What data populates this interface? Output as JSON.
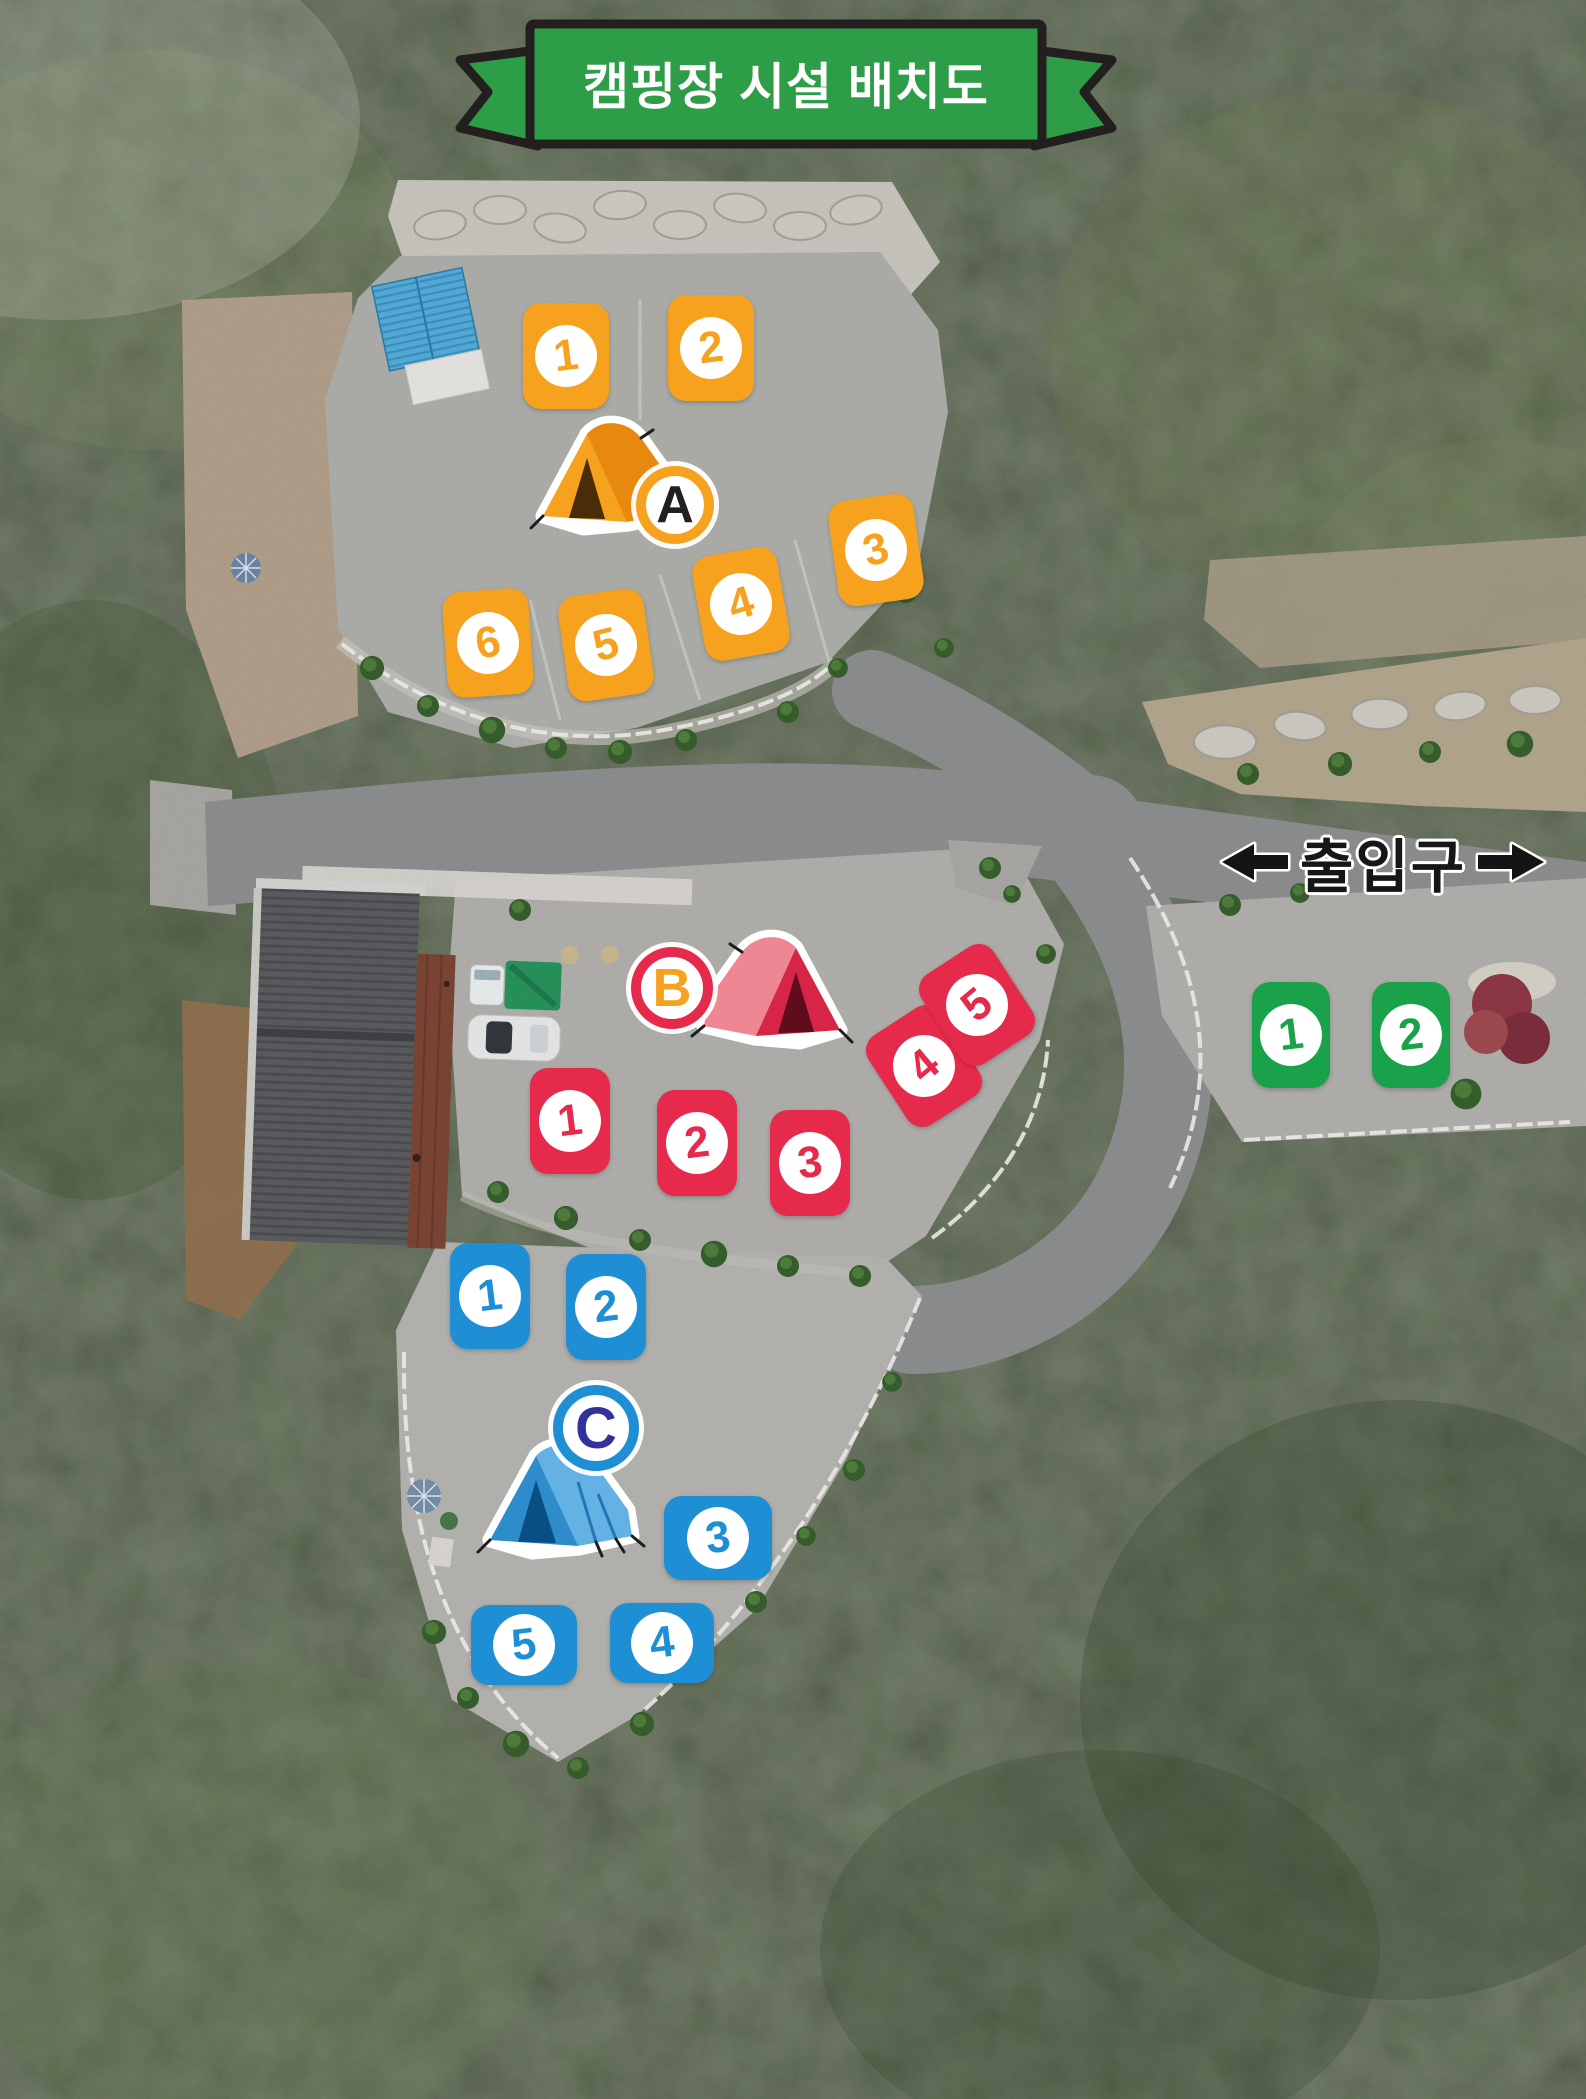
{
  "title": {
    "text": "캠핑장 시설 배치도"
  },
  "entrance_sign": {
    "label": "출입구"
  },
  "zones": [
    {
      "id": "A",
      "label": "A",
      "color": "#f6a21e",
      "letter_color": "#231f20",
      "tent_icon": "orange-tent-icon",
      "sites": [
        {
          "number": "1"
        },
        {
          "number": "2"
        },
        {
          "number": "3"
        },
        {
          "number": "4"
        },
        {
          "number": "5"
        },
        {
          "number": "6"
        }
      ]
    },
    {
      "id": "B",
      "label": "B",
      "color": "#e62a4c",
      "letter_color": "#f6a21e",
      "tent_icon": "red-tent-icon",
      "sites": [
        {
          "number": "1"
        },
        {
          "number": "2"
        },
        {
          "number": "3"
        },
        {
          "number": "4"
        },
        {
          "number": "5"
        }
      ]
    },
    {
      "id": "C",
      "label": "C",
      "color": "#1e8fd5",
      "letter_color": "#32329b",
      "tent_icon": "blue-tent-icon",
      "sites": [
        {
          "number": "1"
        },
        {
          "number": "2"
        },
        {
          "number": "3"
        },
        {
          "number": "4"
        },
        {
          "number": "5"
        }
      ]
    },
    {
      "id": "entrance-area",
      "label": "",
      "color": "#1aa24b",
      "sites": [
        {
          "number": "1"
        },
        {
          "number": "2"
        }
      ]
    }
  ],
  "colors": {
    "banner_green": "#2e9d47",
    "banner_outline": "#241f1f",
    "zone_a_orange": "#f6a21e",
    "zone_b_red": "#e62a4c",
    "zone_c_blue": "#1e8fd5",
    "entrance_tile_green": "#1aa24b",
    "sign_black": "#161616"
  }
}
